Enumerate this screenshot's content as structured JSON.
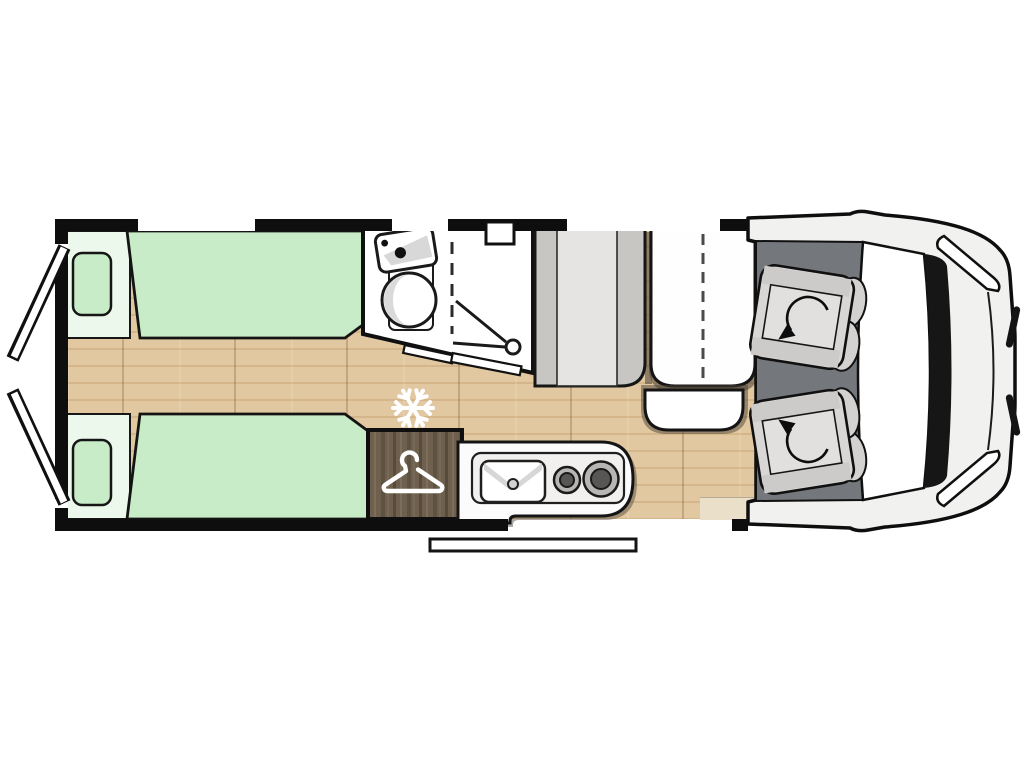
{
  "page": {
    "background": "#ffffff",
    "kind": "campervan-floor-plan-top-view",
    "orientation": "cab-front-on-right, rear-doors-on-left"
  },
  "floor_plan": {
    "areas": [
      {
        "name": "rear-twin-bed-top",
        "type": "single-bed",
        "pillows": 1
      },
      {
        "name": "rear-twin-bed-bottom",
        "type": "single-bed",
        "pillows": 1
      },
      {
        "name": "center-aisle",
        "type": "wood-floor"
      },
      {
        "name": "bathroom",
        "fixtures": [
          "washbasin",
          "round-bowl",
          "shower",
          "folding-door",
          "roof-vent"
        ]
      },
      {
        "name": "tall-unit",
        "type": "cabinet"
      },
      {
        "name": "dinette-bench",
        "type": "two-seat-bench",
        "seam": "dashed"
      },
      {
        "name": "dinette-table",
        "type": "table"
      },
      {
        "name": "wardrobe",
        "icon": "hanger-icon"
      },
      {
        "name": "fridge-marker",
        "icon": "snowflake-icon"
      },
      {
        "name": "kitchen",
        "fixtures": [
          "sink",
          "hob-burner-small",
          "hob-burner-large"
        ]
      },
      {
        "name": "cab",
        "seats": [
          "driver-swivel-seat",
          "passenger-swivel-seat"
        ]
      },
      {
        "name": "entry-step",
        "type": "exterior-step"
      }
    ],
    "counts": {
      "beds": 2,
      "pillows": 2,
      "cab_seats": 2,
      "hob_burners": 2,
      "top_wall_windows": 3,
      "rear_doors_open": 2
    },
    "icons": [
      "snowflake-icon",
      "hanger-icon",
      "shower-head-icon",
      "swivel-arrow-icon",
      "faucet-dots-icon",
      "sink-drain-icon"
    ]
  },
  "colors": {
    "wall": "#0e0e0e",
    "wood": "#dcbf97",
    "bed_green": "#c9ecc8",
    "bed_head": "#ecf8ec",
    "wardrobe_wood": "#6f604d",
    "cab_floor": "#74787c",
    "unit_gray": "#c8c6c3",
    "unit_gray_light": "#e5e4e2",
    "furniture_white": "#fefefe",
    "seat_gray": "#d8d7d5",
    "shadow_brown": "#4a4036",
    "body_white": "#f1f1f0"
  }
}
